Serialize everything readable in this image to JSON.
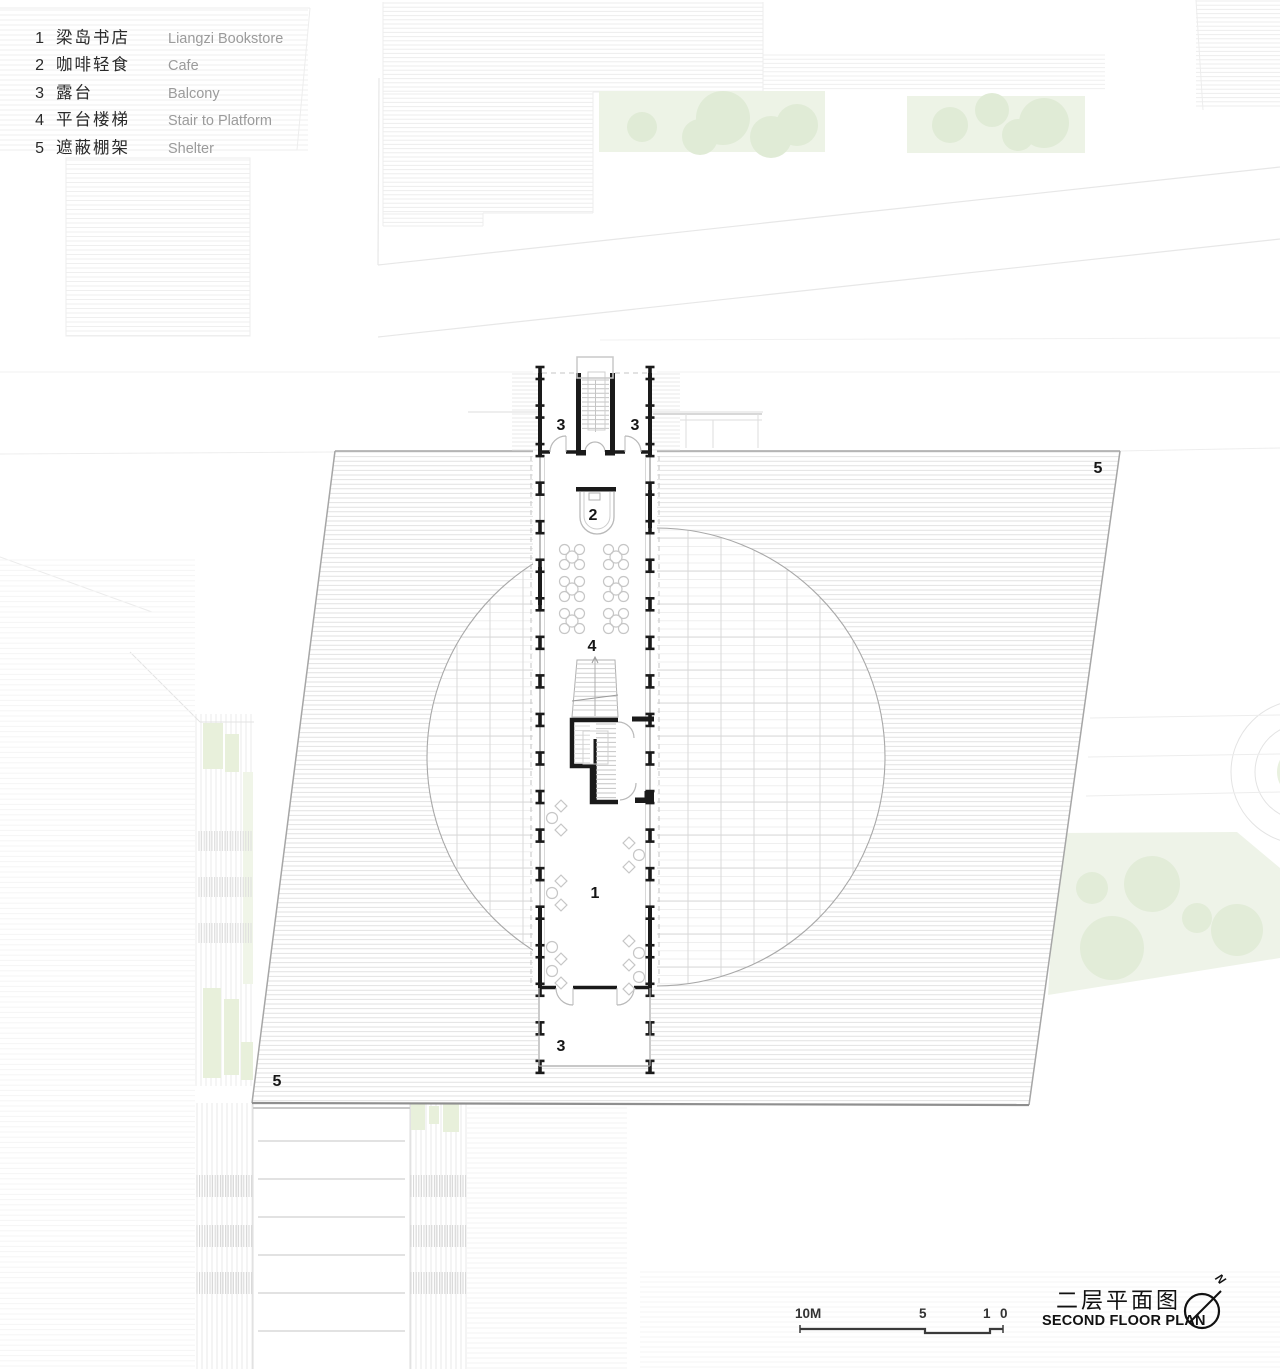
{
  "legend": {
    "items": [
      {
        "num": "1",
        "zh": "梁岛书店",
        "en": "Liangzi Bookstore"
      },
      {
        "num": "2",
        "zh": "咖啡轻食",
        "en": "Cafe"
      },
      {
        "num": "3",
        "zh": "露台",
        "en": "Balcony"
      },
      {
        "num": "4",
        "zh": "平台楼梯",
        "en": "Stair to Platform"
      },
      {
        "num": "5",
        "zh": "遮蔽棚架",
        "en": "Shelter"
      }
    ]
  },
  "plan_labels": [
    {
      "text": "3",
      "x": 561,
      "y": 427
    },
    {
      "text": "3",
      "x": 635,
      "y": 427
    },
    {
      "text": "5",
      "x": 1098,
      "y": 470
    },
    {
      "text": "2",
      "x": 593,
      "y": 517
    },
    {
      "text": "4",
      "x": 592,
      "y": 648
    },
    {
      "text": "1",
      "x": 595,
      "y": 895
    },
    {
      "text": "3",
      "x": 561,
      "y": 1048
    },
    {
      "text": "5",
      "x": 277,
      "y": 1083
    }
  ],
  "title": {
    "zh": "二层平面图",
    "en": "SECOND FLOOR PLAN"
  },
  "north_label": "N",
  "scale_bar": {
    "labels": [
      "10M",
      "5",
      "1",
      "0"
    ]
  },
  "colors": {
    "hatch": "#e2e2e2",
    "shelter_edge": "#a6a6a6",
    "shelter_edge_dark": "#8f8f8f",
    "grid": "#d8d8d8",
    "fine": "#efefef",
    "wall": "#1a1a1a",
    "line_gray": "#b9b9b9",
    "furniture": "#c6c6c6",
    "bg_line": "#ededed",
    "bg_line_faint": "#f3f3f3",
    "lawn": "#edf3e6",
    "tree": "#e0ebd6",
    "planter": "#e8f0db"
  }
}
